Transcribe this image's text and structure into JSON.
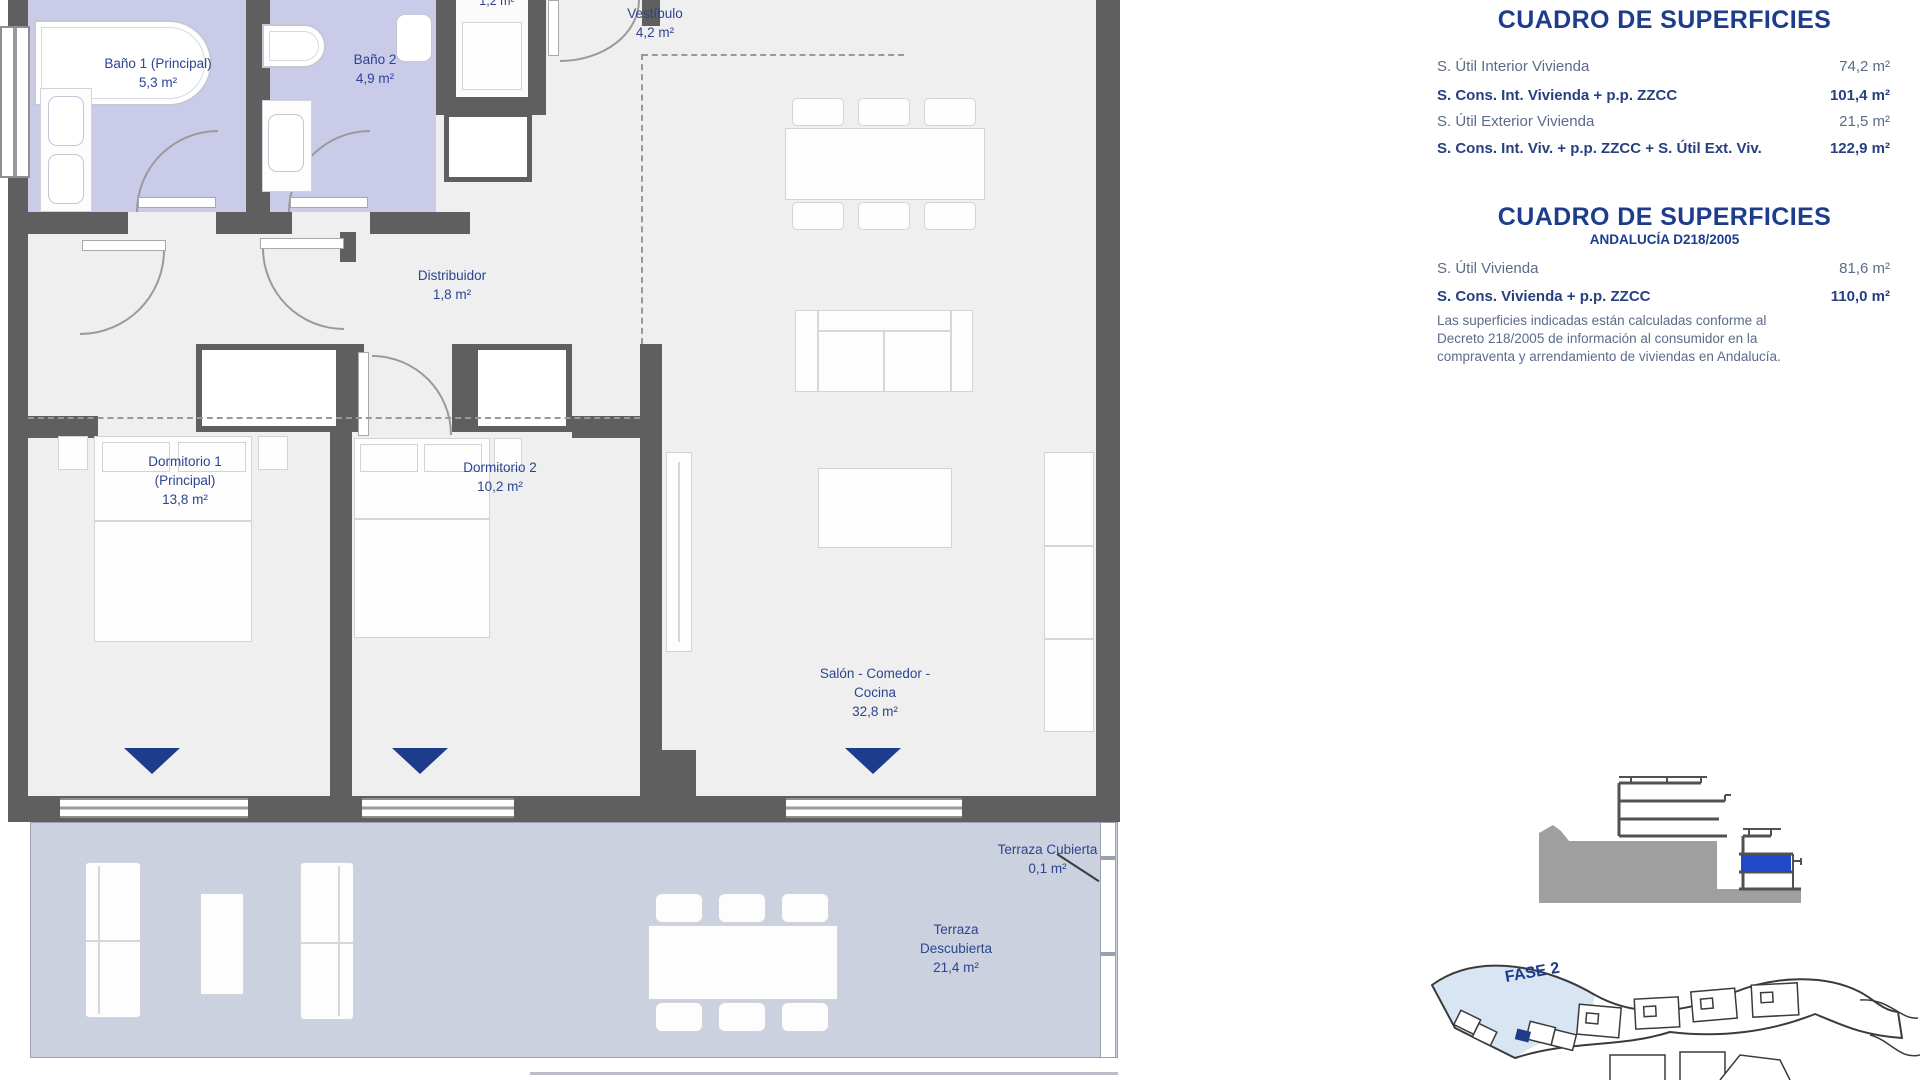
{
  "plan": {
    "rooms": [
      {
        "id": "bano1",
        "line1": "Baño 1 (Principal)",
        "line2": "5,3 m²"
      },
      {
        "id": "bano2",
        "line1": "Baño 2",
        "line2": "4,9 m²"
      },
      {
        "id": "lavadero",
        "line1": "1,2 m²"
      },
      {
        "id": "vestibulo",
        "line1": "Vestíbulo",
        "line2": "4,2 m²"
      },
      {
        "id": "distribuidor",
        "line1": "Distribuidor",
        "line2": "1,8 m²"
      },
      {
        "id": "dormitorio1",
        "line1": "Dormitorio 1",
        "line2": "(Principal)",
        "line3": "13,8 m²"
      },
      {
        "id": "dormitorio2",
        "line1": "Dormitorio 2",
        "line2": "10,2 m²"
      },
      {
        "id": "salon",
        "line1": "Salón - Comedor -",
        "line2": "Cocina",
        "line3": "32,8 m²"
      },
      {
        "id": "terraza-cubierta",
        "line1": "Terraza Cubierta",
        "line2": "0,1 m²"
      },
      {
        "id": "terraza-descubierta",
        "line1": "Terraza",
        "line2": "Descubierta",
        "line3": "21,4 m²"
      }
    ]
  },
  "tables": [
    {
      "title": "CUADRO DE SUPERFICIES",
      "rows": [
        {
          "label": "S. Útil Interior Vivienda",
          "value": "74,2 m²"
        },
        {
          "label": "S. Cons. Int. Vivienda + p.p. ZZCC",
          "value": "101,4 m²"
        },
        {
          "label": "S. Útil Exterior Vivienda",
          "value": "21,5 m²"
        },
        {
          "label": "S. Cons. Int. Viv. + p.p. ZZCC + S. Útil Ext. Viv.",
          "value": "122,9 m²"
        }
      ]
    },
    {
      "title": "CUADRO DE SUPERFICIES",
      "subtitle": "ANDALUCÍA D218/2005",
      "rows": [
        {
          "label": "S. Útil Vivienda",
          "value": "81,6 m²"
        },
        {
          "label": "S. Cons. Vivienda + p.p. ZZCC",
          "value": "110,0 m²"
        }
      ],
      "note": "Las superficies indicadas están calculadas conforme al Decreto 218/2005 de información al consumidor en la compraventa y arrendamiento de viviendas en Andalucía."
    }
  ],
  "site_plan": {
    "phase_label": "FASE 2"
  },
  "colors": {
    "accent_navy": "#1d3c8c",
    "bathroom_fill": "#c9cbe9",
    "terrace_fill": "#ccd1df",
    "wall": "#5f5f5f",
    "floor": "#efeff0",
    "phase_highlight": "#d8e6f4",
    "section_unit_highlight": "#2247c9"
  }
}
